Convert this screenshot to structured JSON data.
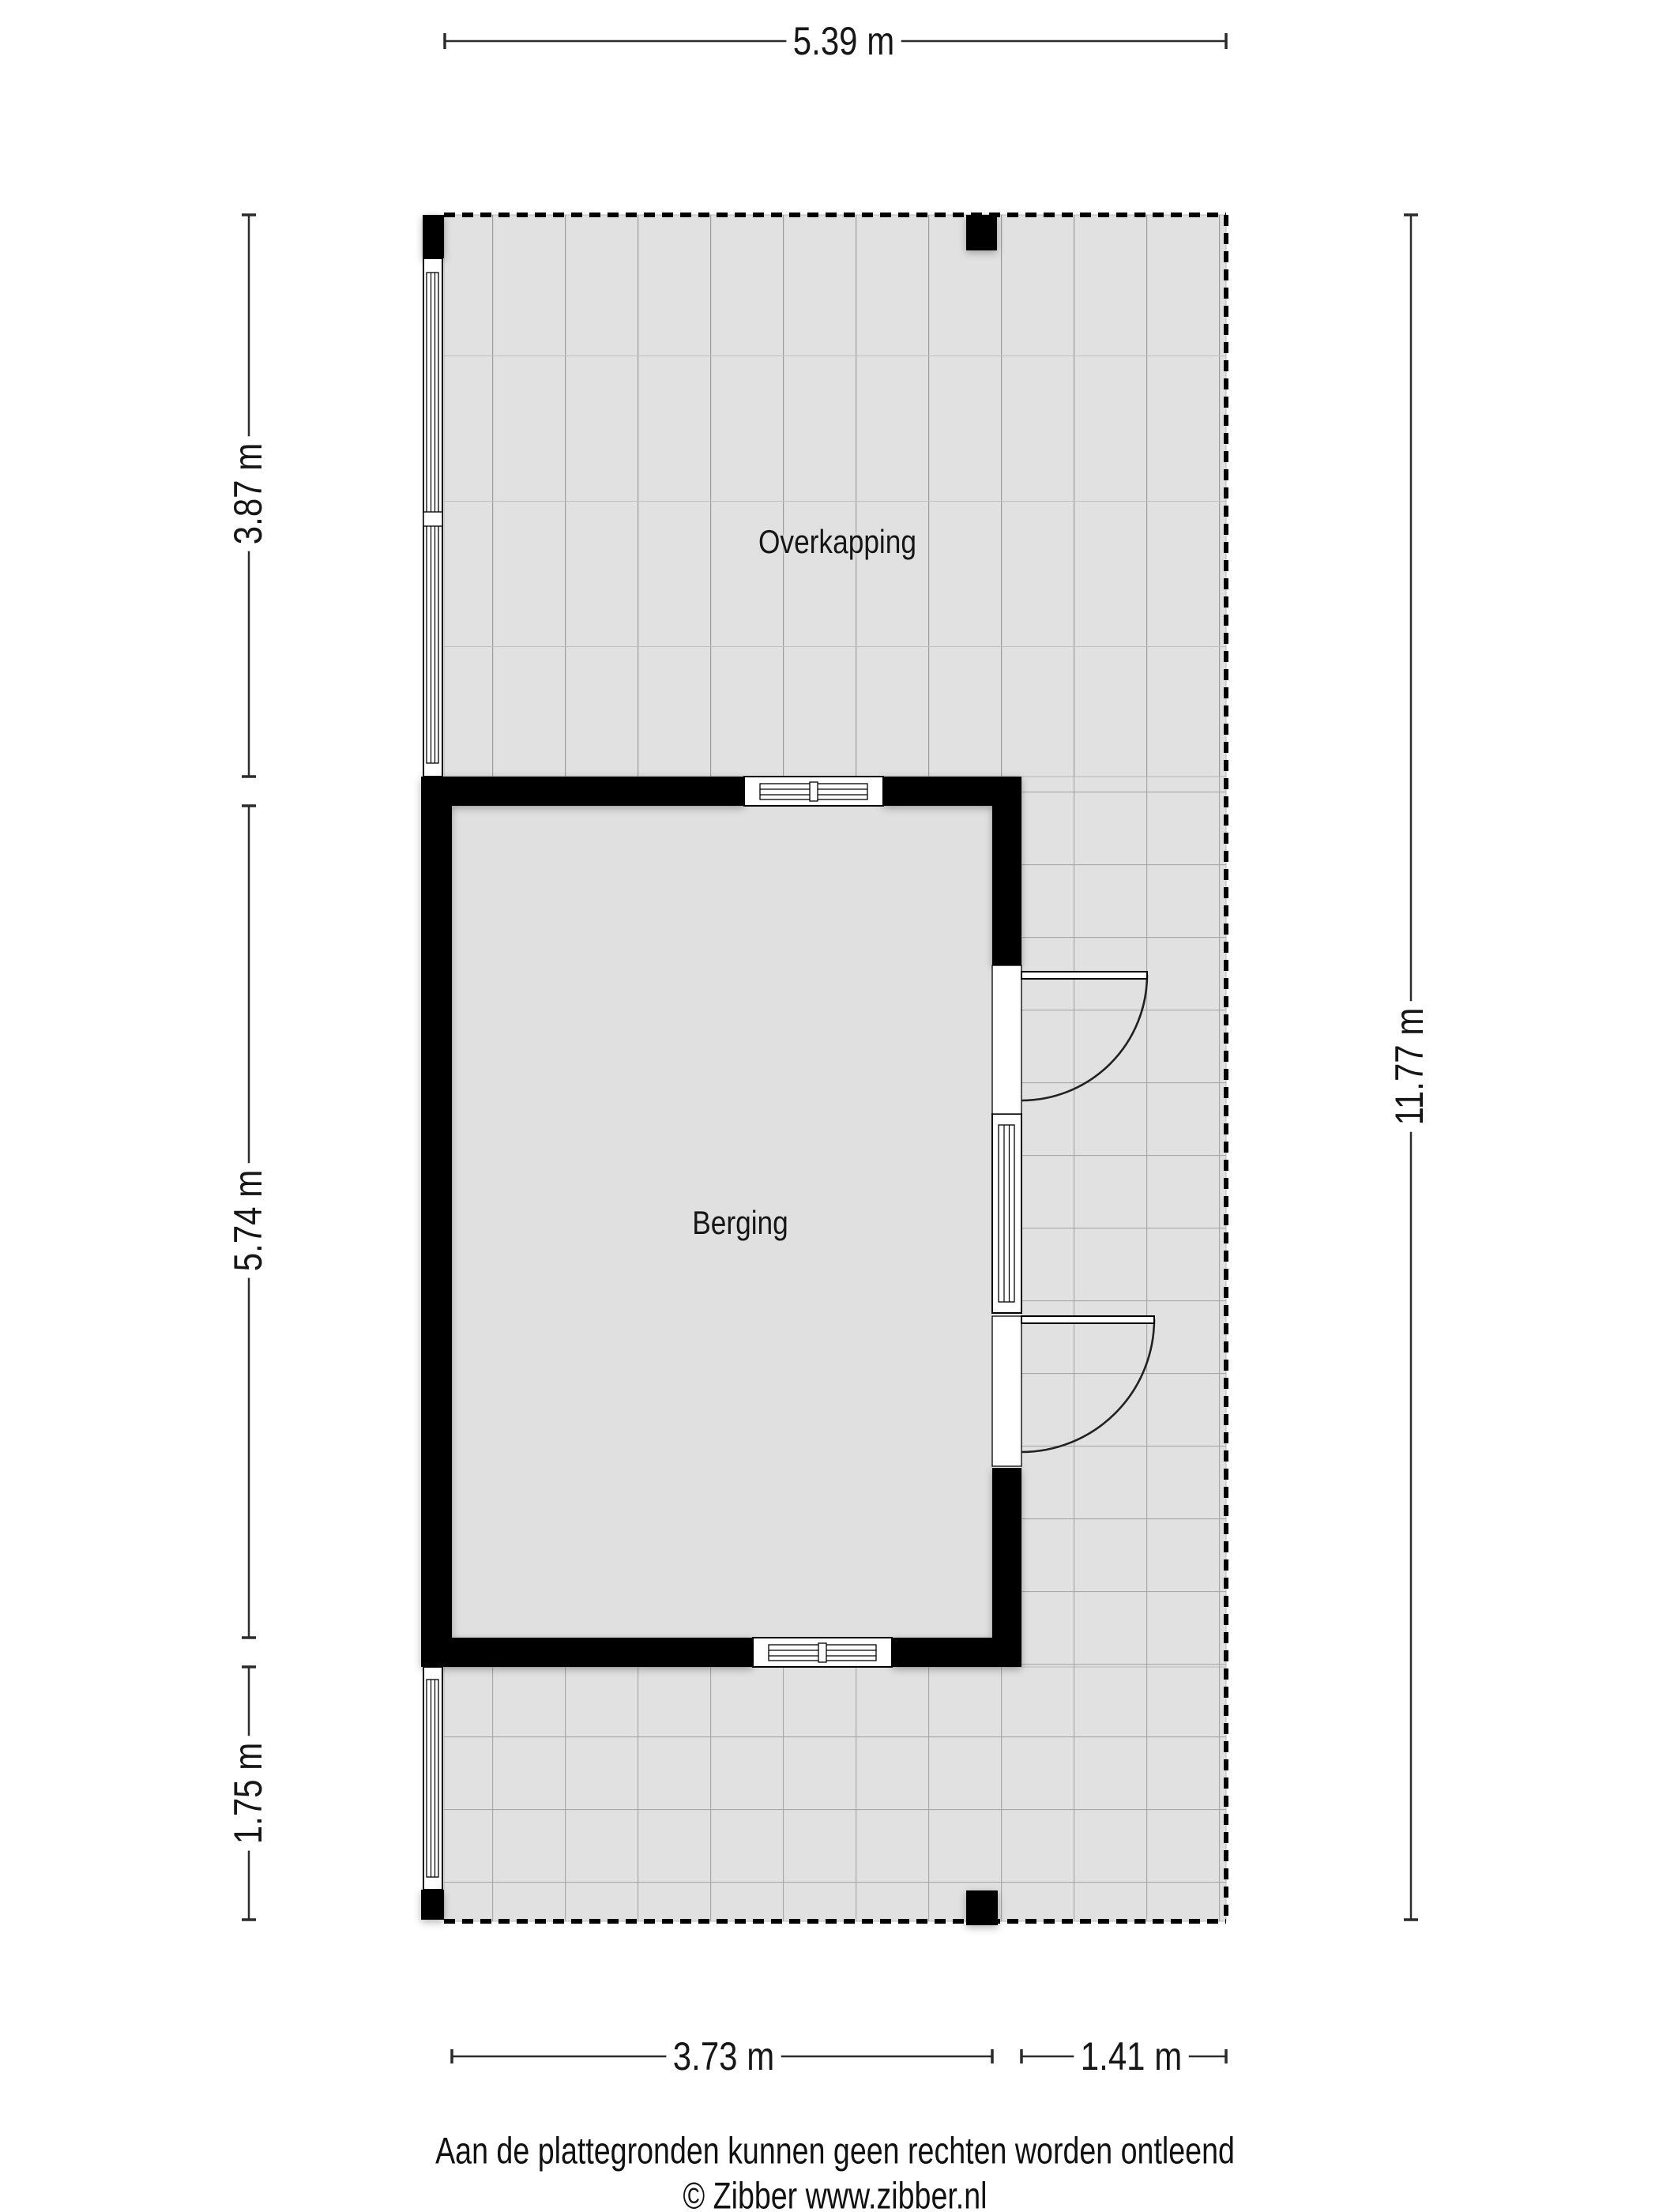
{
  "plan": {
    "type": "floorplan",
    "rooms": [
      {
        "label": "Overkapping"
      },
      {
        "label": "Berging"
      }
    ],
    "dimensions": {
      "top_width": "5.39 m",
      "left_top": "3.87 m",
      "left_middle": "5.74 m",
      "left_bottom": "1.75 m",
      "right_height": "11.77 m",
      "bottom_left": "3.73 m",
      "bottom_right": "1.41 m"
    },
    "colors": {
      "floor": "#e1e1e1",
      "wall": "#000000",
      "grid_line": "#a8a8a8",
      "dimension_line": "#2b2b2b"
    }
  },
  "footer": {
    "disclaimer": "Aan de plattegronden kunnen geen rechten worden ontleend",
    "copyright": "© Zibber www.zibber.nl"
  }
}
